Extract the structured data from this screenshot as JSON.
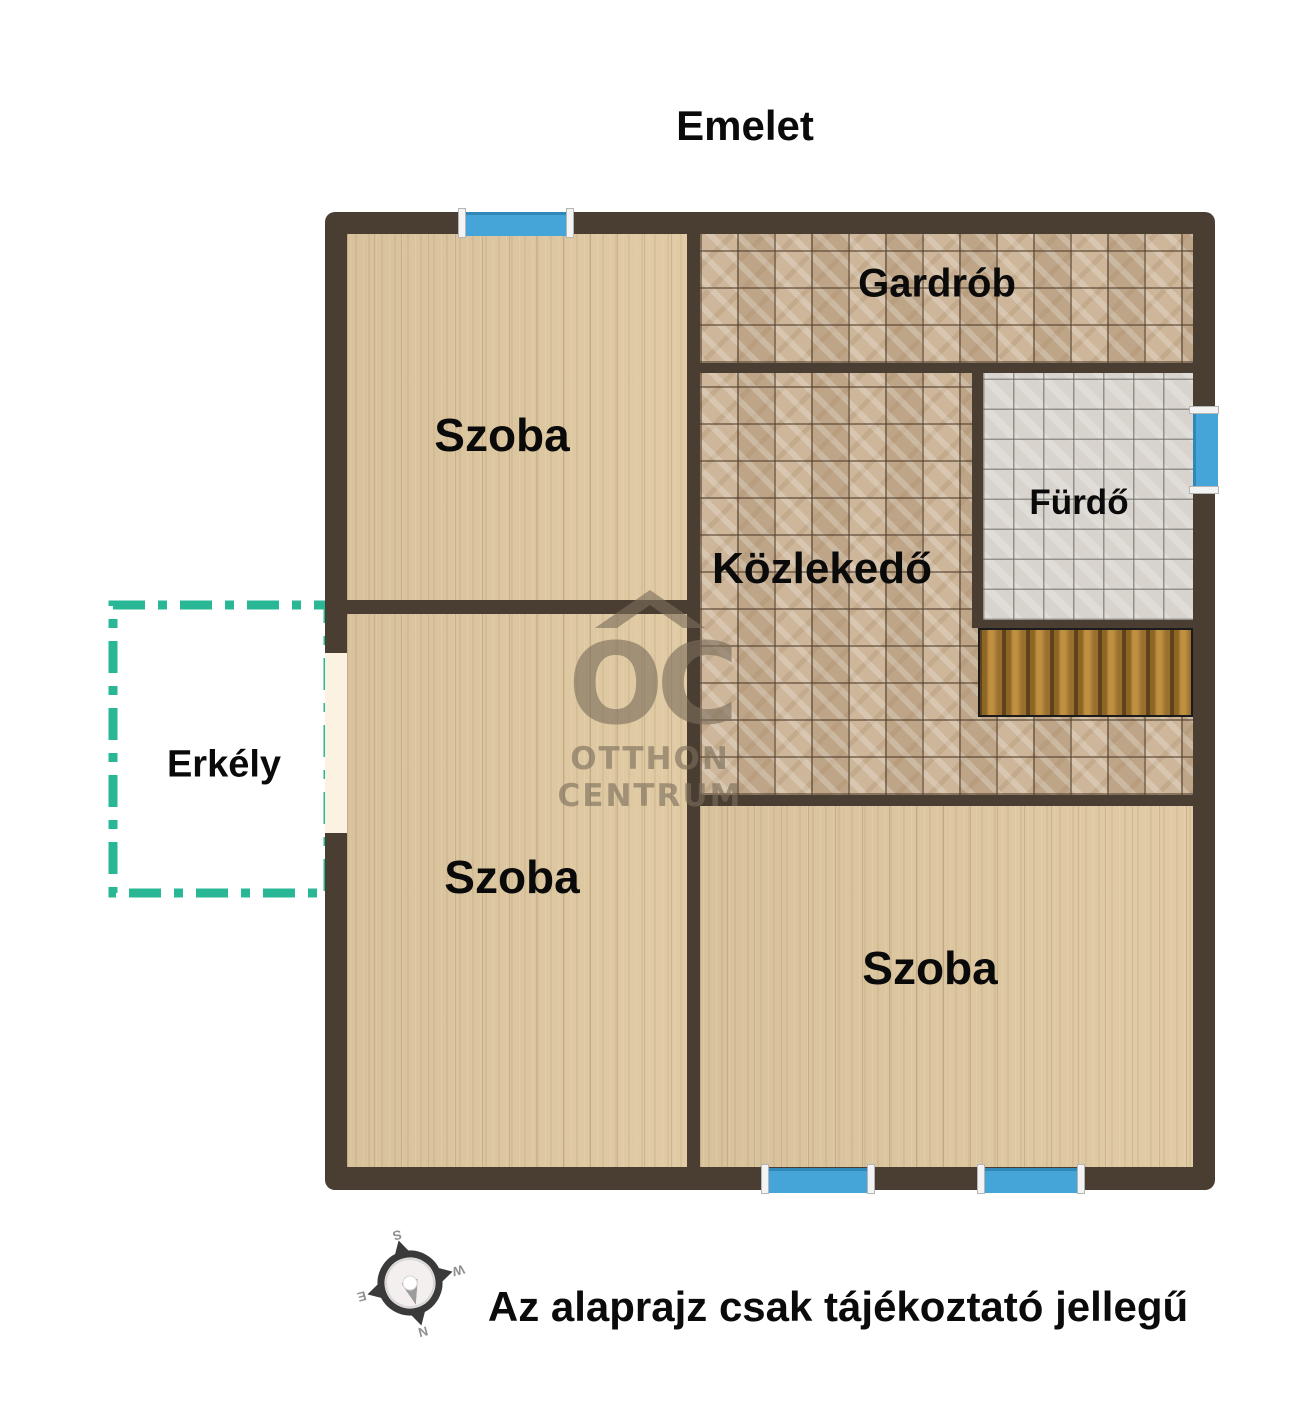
{
  "title": "Emelet",
  "disclaimer": "Az alaprajz csak tájékoztató jellegű",
  "rooms": [
    {
      "id": "szoba-top-left",
      "label": "Szoba",
      "floor": "wood"
    },
    {
      "id": "gardrob",
      "label": "Gardrób",
      "floor": "tile-beige"
    },
    {
      "id": "kozlekedo",
      "label": "Közlekedő",
      "floor": "tile-beige"
    },
    {
      "id": "furdo",
      "label": "Fürdő",
      "floor": "tile-gray"
    },
    {
      "id": "szoba-bottom-left",
      "label": "Szoba",
      "floor": "wood"
    },
    {
      "id": "szoba-bottom-right",
      "label": "Szoba",
      "floor": "wood"
    }
  ],
  "balcony": {
    "label": "Erkély",
    "outline_color": "#2ab795"
  },
  "watermark": {
    "monogram": "OC",
    "line1": "OTTHON",
    "line2": "CENTRUM"
  },
  "compass": {
    "letters": {
      "top": "S",
      "right": "W",
      "bottom": "N",
      "left": "E"
    }
  },
  "features": {
    "windows": 4,
    "stairs": 1,
    "balcony_doors": 1
  },
  "colors": {
    "wall": "#4a3e33",
    "wood_floor": "#dfc8a0",
    "beige_tile": "#c8ae8f",
    "gray_tile": "#d8d4cd",
    "stairs": "#a0742c",
    "window": "#45a5d8",
    "balcony_outline": "#2ab795",
    "balcony_door": "#fcf2e2",
    "text": "#0b0b0b",
    "watermark": "#7a6e5b",
    "needle_red": "#c9203e"
  }
}
